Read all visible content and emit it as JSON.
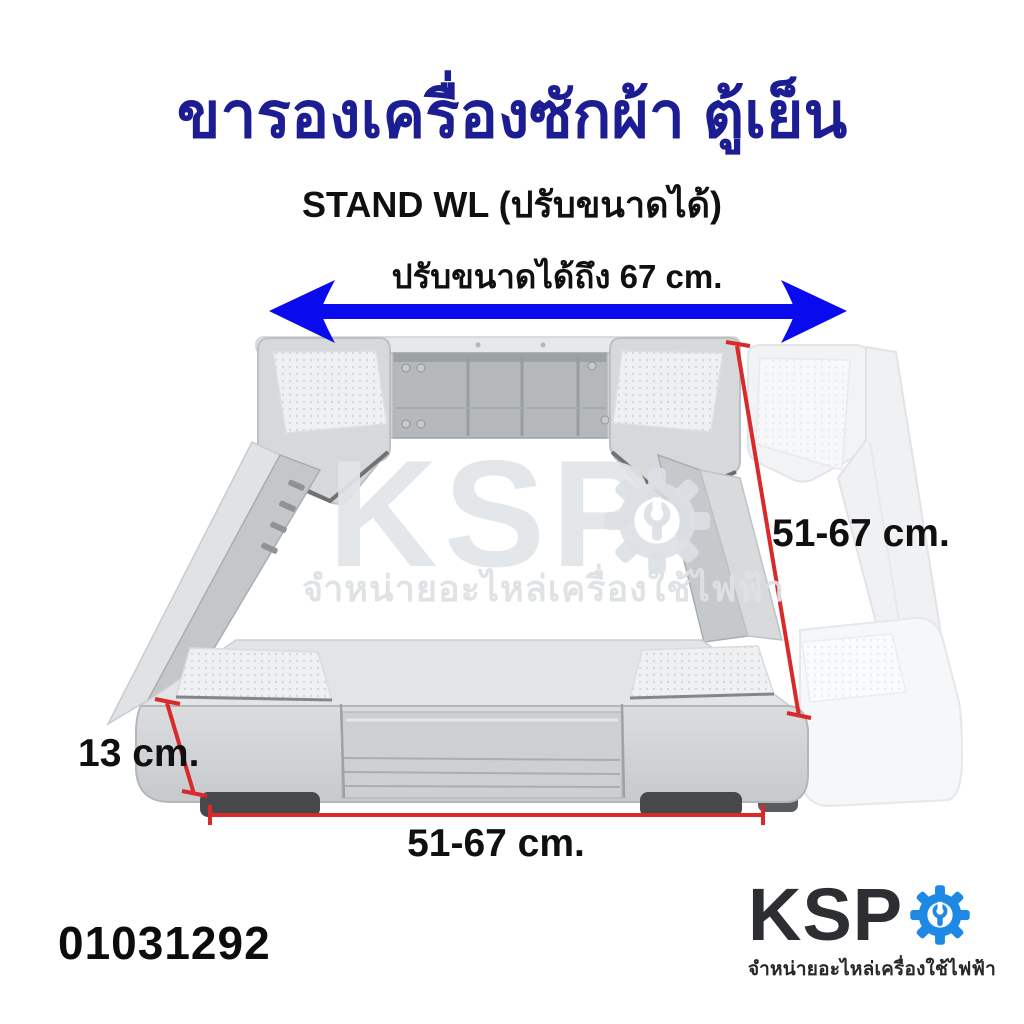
{
  "page": {
    "background": "#ffffff"
  },
  "header": {
    "title": "ขารองเครื่องซักผ้า ตู้เย็น",
    "title_color": "#1d1d93",
    "subtitle": "STAND WL (ปรับขนาดได้)"
  },
  "annotations": {
    "width_arrow_label": "ปรับขนาดได้ถึง 67 cm.",
    "arrow_color": "#0a0aee",
    "dimension_line_color": "#d8292b",
    "right_dimension_label": "51-67 cm.",
    "bottom_dimension_label": "51-67 cm.",
    "height_dimension_label": "13 cm."
  },
  "product": {
    "description": "adjustable washing machine / refrigerator stand, gray plastic frame with extended white ghost frame",
    "frame_color": "#d6d8da",
    "ghost_frame_color": "#f3f4f6",
    "foot_color": "#46484b"
  },
  "watermark": {
    "brand": "KSP",
    "tagline": "จำหน่ายอะไหล่เครื่องใช้ไฟฟ้า"
  },
  "footer": {
    "product_code": "01031292",
    "logo": {
      "brand": "KSP",
      "tagline": "จำหน่ายอะไหล่เครื่องใช้ไฟฟ้า",
      "gear_color": "#1e88e5",
      "text_color": "#2c2e31"
    }
  }
}
